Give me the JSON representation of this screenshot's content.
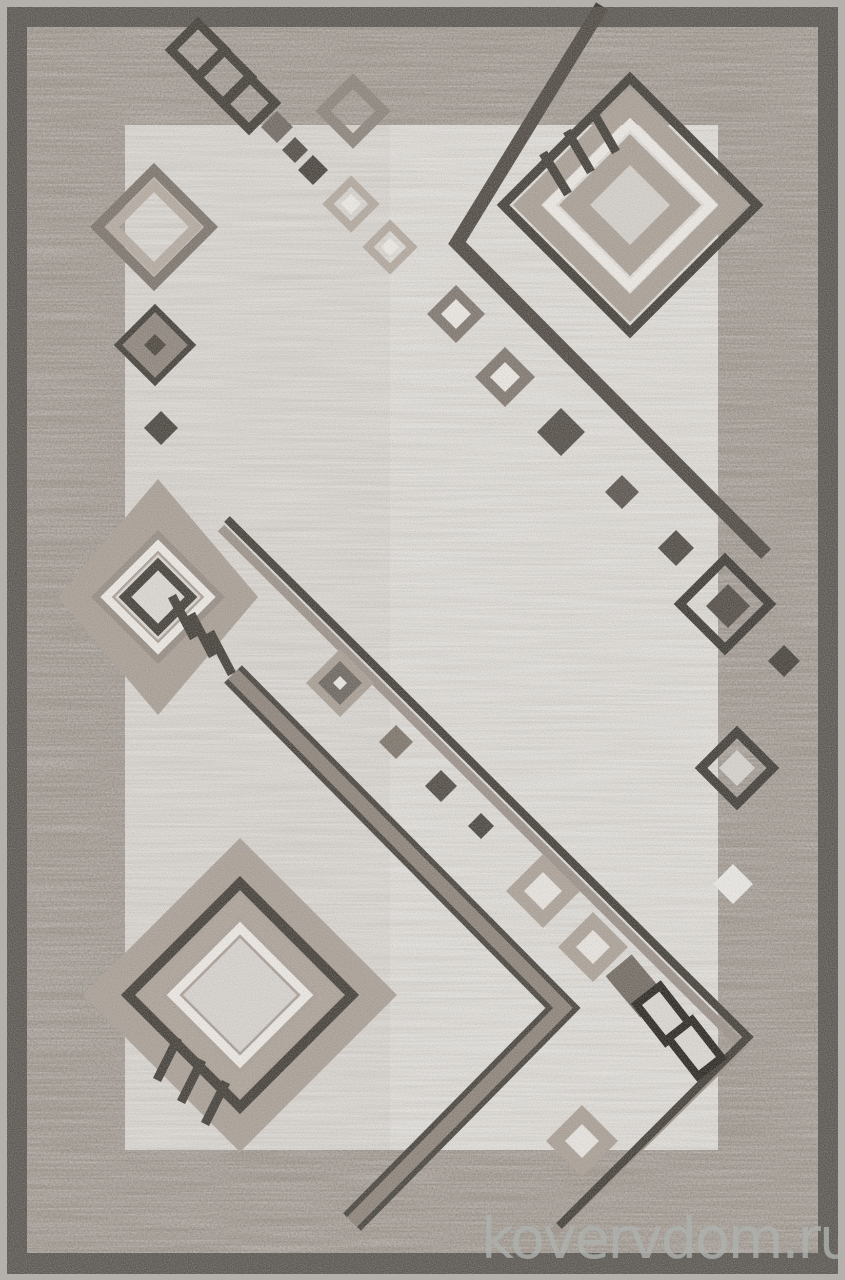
{
  "image": {
    "type": "product-photo",
    "subject": "Gray-beige pile rug with abstract geometric diamond pattern",
    "description": "Portrait-orientation photograph of a rectangular carpet. Mottled light-gray field framed by a dark gray border; decorated with concentric diamond motifs in charcoal, taupe and white, long diagonal chevron lines, diagonal chains of small solid and outlined diamonds, and short triple hatch strokes crossing the large diamonds.",
    "orientation": "portrait"
  },
  "watermark": {
    "text": "kovervdom.ru"
  },
  "palette": {
    "edge": "#b4b1ad",
    "frame": "#57534e",
    "border_band": "#9f968e",
    "field": "#d7d4d0",
    "field_light": "#e3e1de",
    "charcoal": "#3f3b35",
    "dark_gray": "#4c4640",
    "mid_gray": "#7d756d",
    "taupe": "#a89e94",
    "light_taupe": "#b1a79d",
    "white_accent": "#ebe8e4",
    "watermark_color": "#aeb2af"
  },
  "motifs": [
    "outer-frame-border",
    "top-left-diamond-outline-chain",
    "top-left-solid-diamond-chain",
    "left-double-ring-diamond",
    "left-filled-diamond",
    "top-center-ring-diamonds",
    "top-right-concentric-diamond-with-hatches",
    "long-angled-line-top-right",
    "middle-left-concentric-diamond-with-hatches",
    "outer-chevron-line",
    "inner-chevron-band",
    "diagonal-small-diamond-chain",
    "right-column-small-diamonds",
    "bottom-right-corner-cluster",
    "bottom-left-concentric-diamond-with-hatches"
  ]
}
